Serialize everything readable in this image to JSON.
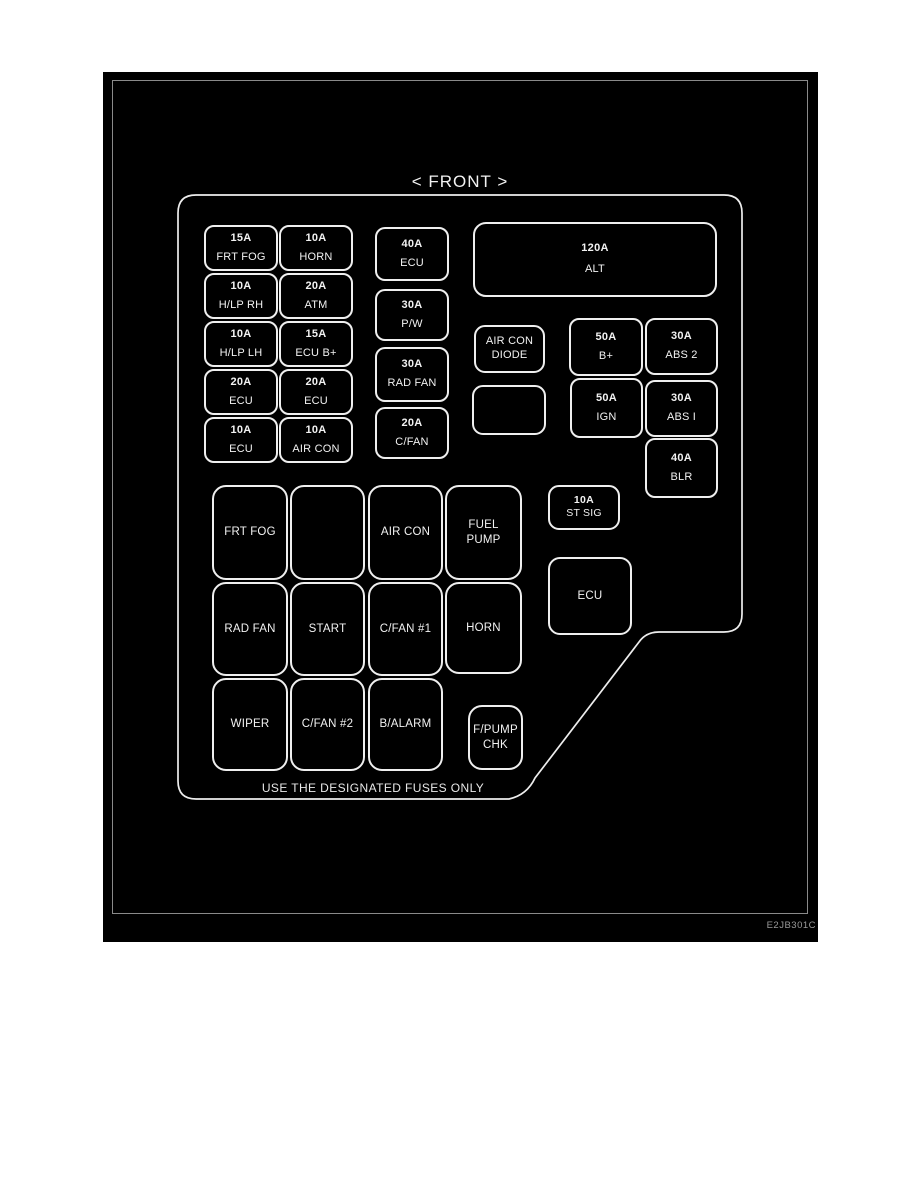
{
  "title": "< FRONT >",
  "footer_note": "USE THE DESIGNATED FUSES ONLY",
  "figure_code": "E2JB301C",
  "boxes": [
    {
      "id": "l1",
      "amp": "15A",
      "name": "FRT FOG"
    },
    {
      "id": "l2",
      "amp": "10A",
      "name": "HORN"
    },
    {
      "id": "l3",
      "amp": "10A",
      "name": "H/LP RH"
    },
    {
      "id": "l4",
      "amp": "20A",
      "name": "ATM"
    },
    {
      "id": "l5",
      "amp": "10A",
      "name": "H/LP LH"
    },
    {
      "id": "l6",
      "amp": "15A",
      "name": "ECU B+"
    },
    {
      "id": "l7",
      "amp": "20A",
      "name": "ECU"
    },
    {
      "id": "l8",
      "amp": "20A",
      "name": "ECU"
    },
    {
      "id": "l9",
      "amp": "10A",
      "name": "ECU"
    },
    {
      "id": "l10",
      "amp": "10A",
      "name": "AIR CON"
    },
    {
      "id": "m1",
      "amp": "40A",
      "name": "ECU"
    },
    {
      "id": "m2",
      "amp": "30A",
      "name": "P/W"
    },
    {
      "id": "m3",
      "amp": "30A",
      "name": "RAD FAN"
    },
    {
      "id": "m4",
      "amp": "20A",
      "name": "C/FAN"
    },
    {
      "id": "r1",
      "amp": "120A",
      "name": "ALT"
    },
    {
      "id": "r2",
      "amp": null,
      "name": "AIR CON\nDIODE"
    },
    {
      "id": "r3",
      "amp": null,
      "name": null
    },
    {
      "id": "r4",
      "amp": "50A",
      "name": "B+"
    },
    {
      "id": "r5",
      "amp": "30A",
      "name": "ABS 2"
    },
    {
      "id": "r6",
      "amp": "50A",
      "name": "IGN"
    },
    {
      "id": "r7",
      "amp": "30A",
      "name": "ABS I"
    },
    {
      "id": "r8",
      "amp": "40A",
      "name": "BLR"
    },
    {
      "id": "r9",
      "amp": "10A",
      "name": "ST SIG"
    },
    {
      "id": "r10",
      "amp": null,
      "name": "ECU"
    },
    {
      "id": "g1",
      "amp": null,
      "name": "FRT FOG"
    },
    {
      "id": "g2",
      "amp": null,
      "name": null
    },
    {
      "id": "g3",
      "amp": null,
      "name": "AIR CON"
    },
    {
      "id": "g4",
      "amp": null,
      "name": "FUEL\nPUMP"
    },
    {
      "id": "g5",
      "amp": null,
      "name": "RAD FAN"
    },
    {
      "id": "g6",
      "amp": null,
      "name": "START"
    },
    {
      "id": "g7",
      "amp": null,
      "name": "C/FAN #1"
    },
    {
      "id": "g8",
      "amp": null,
      "name": "HORN"
    },
    {
      "id": "g9",
      "amp": null,
      "name": "WIPER"
    },
    {
      "id": "g10",
      "amp": null,
      "name": "C/FAN #2"
    },
    {
      "id": "g11",
      "amp": null,
      "name": "B/ALARM"
    },
    {
      "id": "g12",
      "amp": null,
      "name": "F/PUMP\nCHK"
    }
  ]
}
